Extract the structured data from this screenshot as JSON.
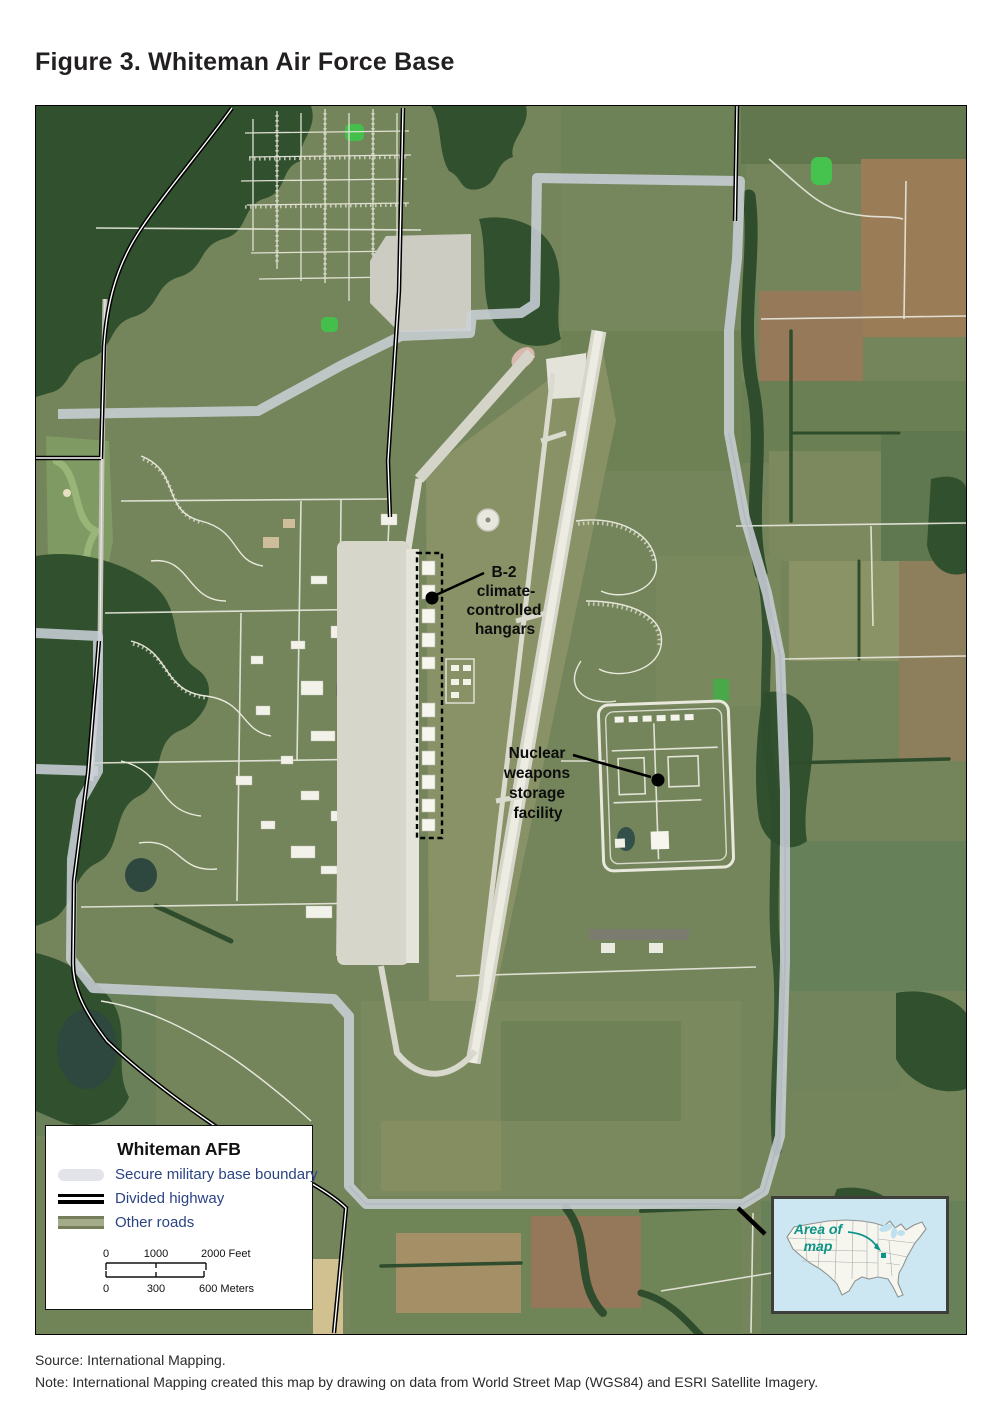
{
  "figure": {
    "title": "Figure 3. Whiteman Air Force Base"
  },
  "map": {
    "annotations": [
      {
        "id": "b2-hangars",
        "lines": [
          "B-2",
          "climate-",
          "controlled",
          "hangars"
        ]
      },
      {
        "id": "nuclear-storage",
        "lines": [
          "Nuclear",
          "weapons",
          "storage",
          "facility"
        ]
      }
    ],
    "legend": {
      "title": "Whiteman AFB",
      "items": [
        {
          "label": "Secure military base boundary"
        },
        {
          "label": "Divided highway"
        },
        {
          "label": "Other roads"
        }
      ],
      "scale": {
        "feet": {
          "t0": "0",
          "t1": "1000",
          "t2": "2000 Feet"
        },
        "meters": {
          "t0": "0",
          "t1": "300",
          "t2": "600 Meters"
        }
      }
    },
    "inset": {
      "label_line1": "Area of",
      "label_line2": "map"
    }
  },
  "footer": {
    "source": "Source: International Mapping.",
    "note": "Note: International Mapping created this map by drawing on data from World Street Map (WGS84) and ESRI Satellite Imagery."
  },
  "colors": {
    "legend_text": "#2a4383",
    "boundary": "#cdd1d9",
    "divided_highway": "#000000",
    "other_roads": "#a3ab89",
    "inset_accent": "#0d9488",
    "annotation_text": "#0d0d0d"
  }
}
